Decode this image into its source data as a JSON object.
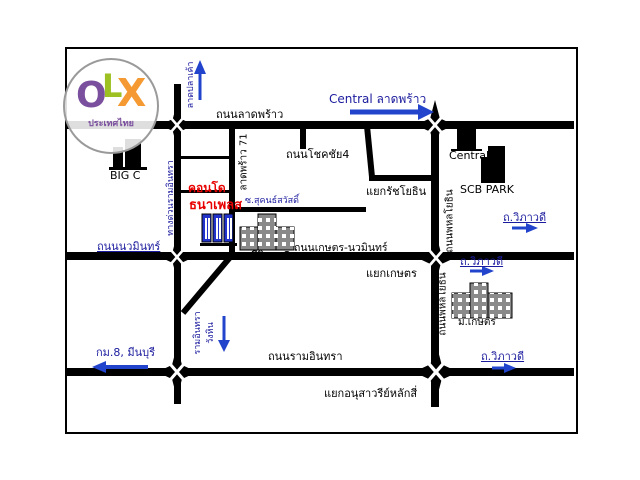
{
  "logo": {
    "letter_o": "O",
    "letter_l": "L",
    "letter_x": "X",
    "subtitle": "ประเทศไทย",
    "color_o": "#7a4f9e",
    "color_l": "#9dc122",
    "color_x": "#f59a32"
  },
  "landmarks": {
    "big_c": "BIG C",
    "central_store": "Central",
    "scb_park": "SCB PARK",
    "school": "สตรีวิทยา2",
    "university": "ม.เกษตร",
    "condo_line1": "คอนโด",
    "condo_line2": "ธนาเพลส"
  },
  "roads": {
    "lat_phrao": "ถนนลาดพร้าว",
    "chokchai4": "ถนนโชคชัย4",
    "kaset_nawamin": "ถนนเกษตร-นวมินทร์",
    "nawamin": "ถนนนวมินทร์",
    "ram_intra": "ถนนรามอินทรา",
    "phahonyothin_upper": "ถนนพหลโยธิน",
    "phahonyothin_lower": "ถนนพหลโยธิน",
    "lat_phrao_71": "ลาดพร้าว 71",
    "expressway": "ทางด่วนรามอินทรา",
    "soi_sukhonthasawat": "ซ.สุคนธ์สวัสดิ์"
  },
  "junctions": {
    "ratchayothin": "แยกรัชโยธิน",
    "kaset": "แยกเกษตร",
    "lak_si": "แยกอนุสาวรีย์หลักสี่"
  },
  "directions": {
    "central_lat_phrao": "Central ลาดพร้าว",
    "km8_minburi": "กม.8, มีนบุรี",
    "vibhavadi_top": "ถ.วิภาวดี",
    "vibhavadi_mid": "ถ.วิภาวดี",
    "vibhavadi_bottom": "ถ.วิภาวดี",
    "north_label": "ลาดปลาเค้า",
    "south_label_1": "รามอินทรา",
    "south_label_2": "วังหิน"
  },
  "colors": {
    "road": "#000000",
    "accent_blue": "#2233aa",
    "condo_red": "#e80000",
    "condo_blue": "#2233cc"
  }
}
